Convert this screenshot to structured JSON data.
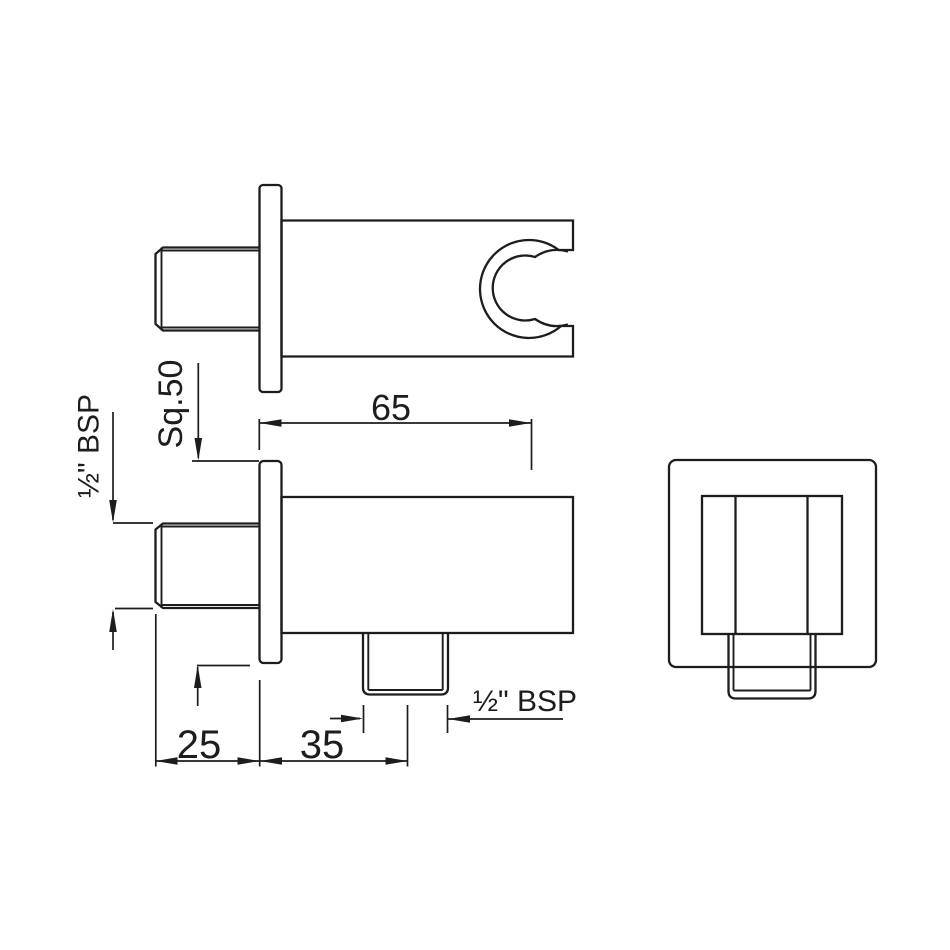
{
  "drawing": {
    "description": "Technical dimension drawing of a square shower wall outlet with hand-shower holder, three orthographic views",
    "background_color": "#ffffff",
    "line_color": "#1d1d1d",
    "labels": {
      "dim_body_length": "65",
      "dim_flange_square": "Sq.50",
      "dim_inlet_thread": "½\" BSP",
      "dim_inlet_projection": "25",
      "dim_outlet_offset": "35",
      "dim_outlet_thread": "½\" BSP"
    }
  }
}
